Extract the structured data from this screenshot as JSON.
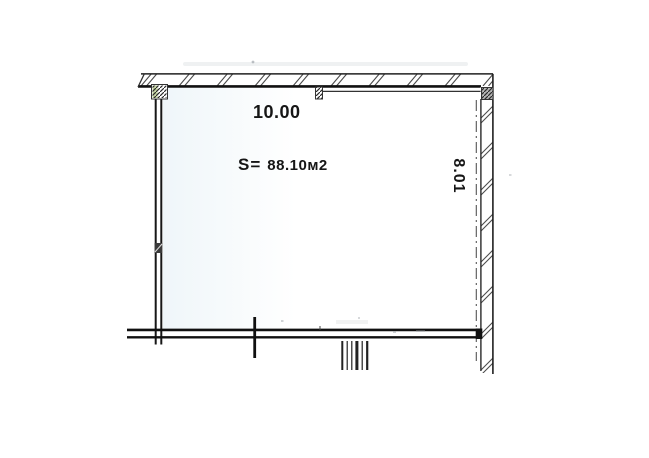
{
  "plan": {
    "dimensions": {
      "width_label": "10.00",
      "height_label": "8.01"
    },
    "area": {
      "prefix": "S=",
      "value": "88.10м2"
    }
  },
  "colors": {
    "line": "#1c1c1c",
    "hatch": "#4a4a4a",
    "axis_dashdot": "#555555",
    "scan_green_accent": "#b5c98b",
    "background": "#ffffff"
  }
}
